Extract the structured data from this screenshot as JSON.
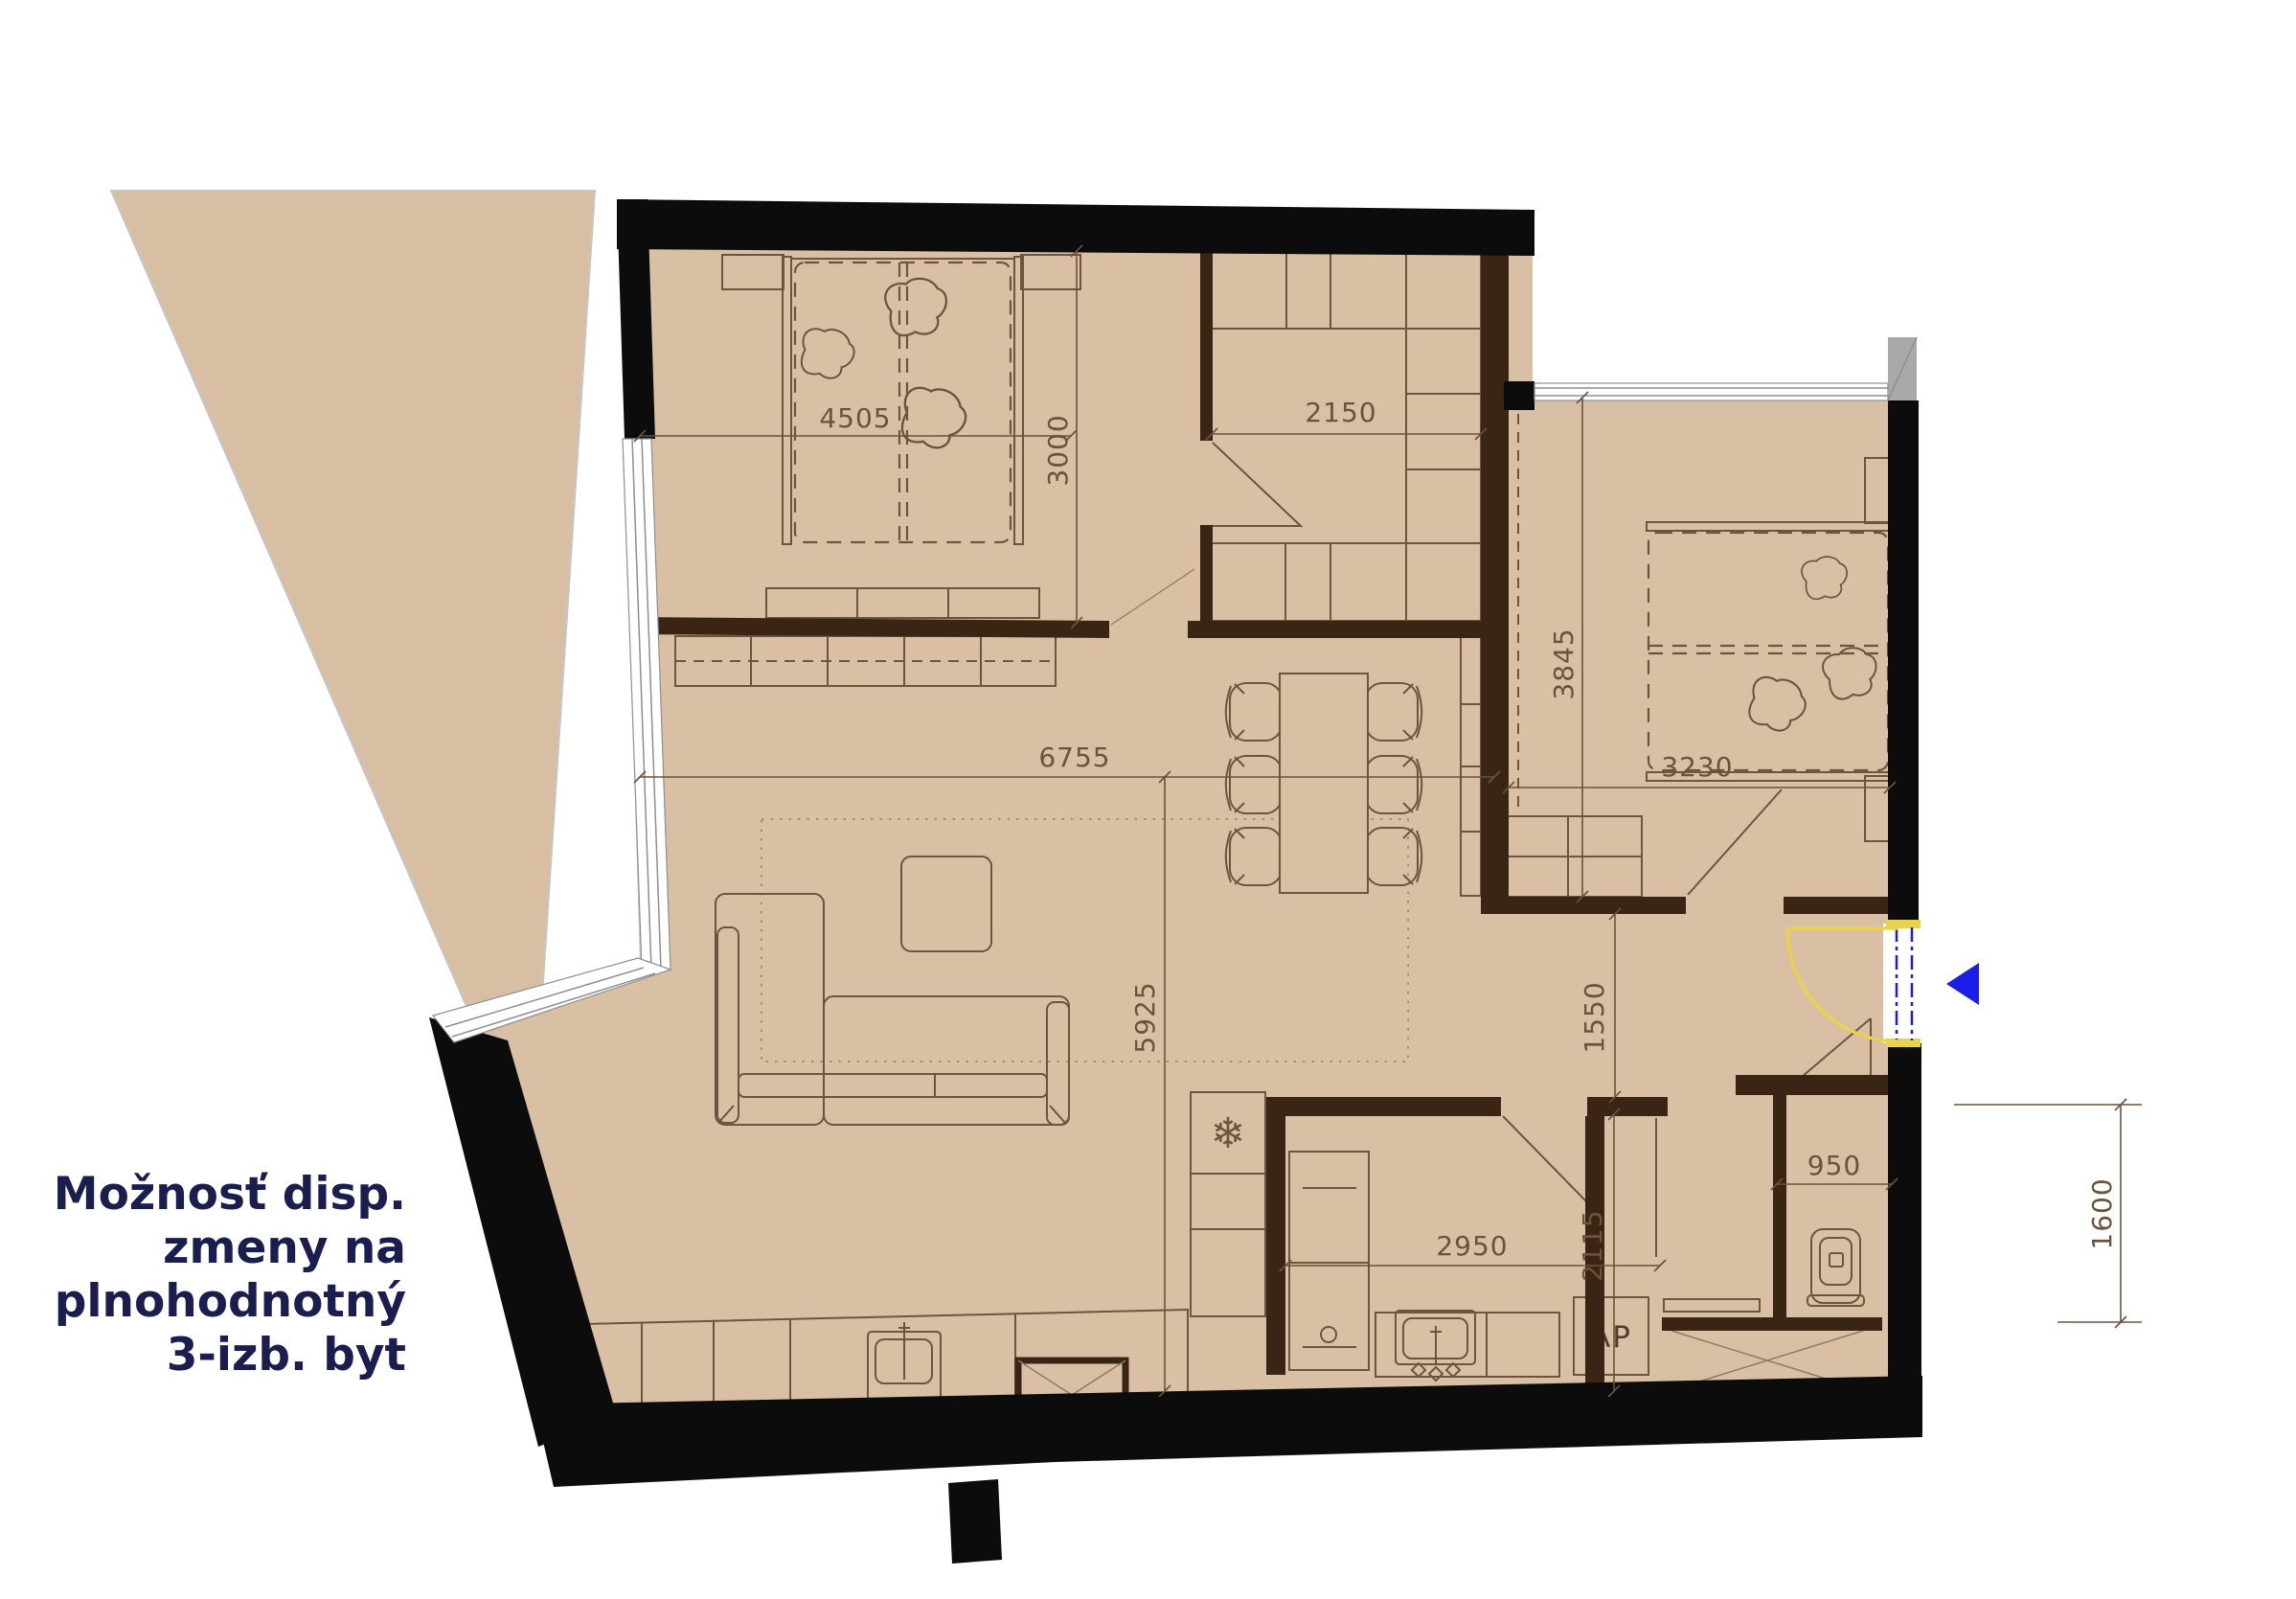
{
  "tagline": {
    "line1": "Možnosť disp.",
    "line2": "zmeny na",
    "line3": "plnohodnotný",
    "line4": "3-izb. byt"
  },
  "dimensions": {
    "bedroom1_width": "4505",
    "bedroom1_depth": "3000",
    "closet_width": "2150",
    "living_width": "6755",
    "living_depth": "5925",
    "bedroom2_depth": "3845",
    "bedroom2_width": "3230",
    "hall_depth": "1550",
    "kitchen_width": "2950",
    "kitchen_depth": "2115",
    "wc_width": "950",
    "entry_side": "1600"
  },
  "labels": {
    "appliance": "AP",
    "freezer_icon": "❄"
  },
  "colors": {
    "floor": "#d9c0a5",
    "terrace": "#d8bfa4",
    "wall_black": "#0c0c0c",
    "wall_brown": "#3a2514",
    "line": "#6e5340",
    "dim_text": "#6b523b",
    "navy": "#1a1e4e",
    "door_yellow": "#e8d34f",
    "door_blue": "#1c1ce8",
    "window_gray": "#a9a9a9",
    "hatch": "#8d7b66"
  }
}
